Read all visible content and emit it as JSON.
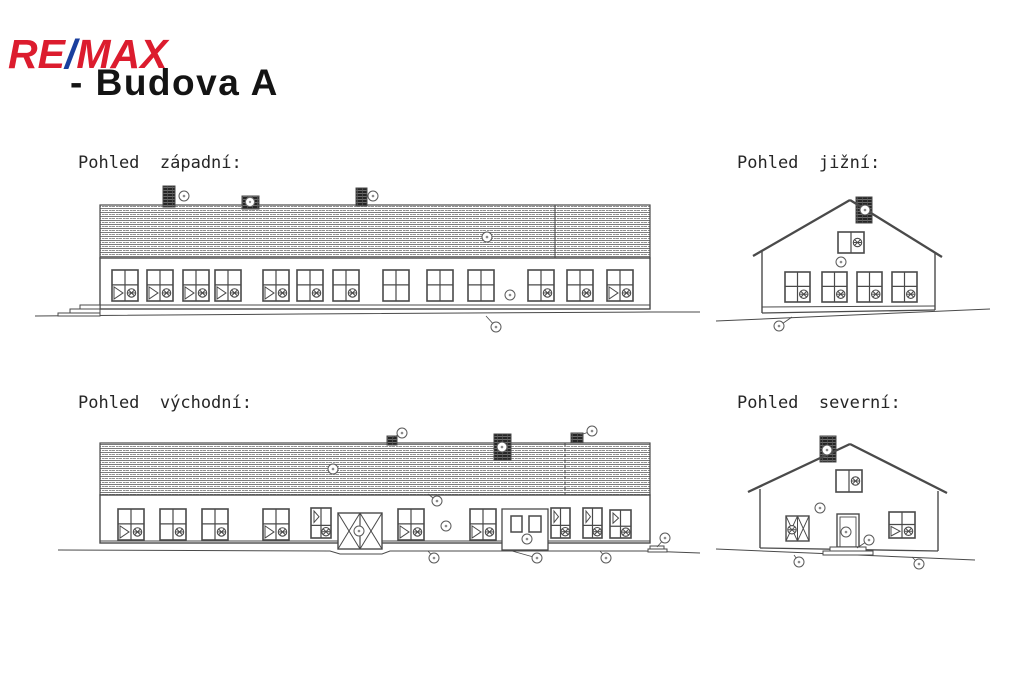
{
  "logo": {
    "re": "RE",
    "slash": "/",
    "max": "MAX",
    "re_color": "#dc1c2e",
    "slash_color": "#1a3f9e",
    "max_color": "#dc1c2e"
  },
  "title": "- Budova A",
  "labels": {
    "west": "Pohled  západní:",
    "south": "Pohled  jižní:",
    "east": "Pohled  východní:",
    "north": "Pohled  severní:"
  },
  "drawings": {
    "ink": "#4a4a4a",
    "west": {
      "type": "long",
      "roof": [
        100,
        205,
        550,
        53
      ],
      "seam": [
        555,
        false
      ],
      "wall": [
        100,
        258,
        550,
        51
      ],
      "plinth": 305,
      "ground": [
        [
          35,
          316
        ],
        [
          300,
          314
        ],
        [
          650,
          312
        ],
        [
          700,
          312
        ]
      ],
      "steps": [
        [
          80,
          305,
          20,
          4
        ],
        [
          70,
          309,
          30,
          4
        ],
        [
          58,
          313,
          42,
          3
        ]
      ],
      "win_def": [
        270,
        26,
        31
      ],
      "windows": [
        [
          112,
          "bl"
        ],
        [
          147,
          "bl"
        ],
        [
          183,
          "bl"
        ],
        [
          215,
          "bl"
        ],
        [
          263,
          "bl"
        ],
        [
          297,
          "br"
        ],
        [
          333,
          "br"
        ],
        [
          383,
          "p"
        ],
        [
          427,
          "p"
        ],
        [
          468,
          "p"
        ],
        [
          528,
          "br"
        ],
        [
          567,
          "br"
        ],
        [
          607,
          "bl"
        ]
      ],
      "chimneys": [
        [
          163,
          186,
          12,
          21
        ],
        [
          356,
          188,
          11,
          18
        ]
      ],
      "vent": [
        242,
        196,
        17,
        13
      ],
      "vent_circle": [
        250,
        202
      ],
      "callouts": [
        [
          184,
          196
        ],
        [
          373,
          196
        ],
        [
          487,
          237
        ],
        [
          510,
          295
        ],
        [
          496,
          327,
          486,
          316
        ]
      ]
    },
    "south": {
      "type": "gable",
      "apex": [
        850,
        200
      ],
      "eaves": [
        [
          753,
          256
        ],
        [
          942,
          257
        ]
      ],
      "wallL": [
        762,
        250,
        313
      ],
      "wallR": [
        935,
        253,
        310
      ],
      "plinth": [
        762,
        307,
        935,
        306
      ],
      "bottom": [
        762,
        313,
        935,
        310
      ],
      "ground": [
        [
          716,
          321
        ],
        [
          990,
          309
        ]
      ],
      "chimney": [
        856,
        197,
        16,
        26
      ],
      "gwin": [
        838,
        232,
        26,
        21
      ],
      "win_def": [
        272,
        25,
        30
      ],
      "windows": [
        [
          785,
          "br"
        ],
        [
          822,
          "br"
        ],
        [
          857,
          "br"
        ],
        [
          892,
          "br"
        ]
      ],
      "callouts": [
        [
          865,
          210
        ],
        [
          841,
          262
        ],
        [
          779,
          326,
          792,
          317
        ]
      ]
    },
    "east": {
      "type": "long",
      "roof": [
        100,
        443,
        550,
        52
      ],
      "seam": [
        565,
        true
      ],
      "wall": [
        100,
        495,
        550,
        48
      ],
      "plinth": 541,
      "ground": [
        [
          58,
          550
        ],
        [
          330,
          551
        ],
        [
          340,
          554
        ],
        [
          382,
          554
        ],
        [
          390,
          551
        ],
        [
          645,
          551
        ],
        [
          700,
          553
        ]
      ],
      "steps": [
        [
          650,
          546,
          14,
          3
        ],
        [
          648,
          549,
          19,
          3
        ]
      ],
      "win_def": [
        509,
        26,
        31
      ],
      "windows": [
        [
          118,
          "bl"
        ],
        [
          160,
          "br"
        ],
        [
          202,
          "br"
        ],
        [
          263,
          "bl"
        ],
        [
          311,
          "tl",
          20,
          30,
          508
        ],
        [
          398,
          "bl"
        ],
        [
          470,
          "bl"
        ],
        [
          551,
          "tl",
          19,
          30,
          508
        ],
        [
          583,
          "tl",
          19,
          30,
          508
        ],
        [
          610,
          "tl",
          21,
          28,
          510
        ]
      ],
      "chimneys": [
        [
          387,
          436,
          10,
          9
        ],
        [
          494,
          434,
          17,
          26
        ],
        [
          571,
          433,
          12,
          10
        ]
      ],
      "xdoor": [
        338,
        513,
        44,
        36
      ],
      "porch": {
        "rect": [
          502,
          509,
          46,
          41
        ],
        "wins": [
          [
            511,
            516,
            11,
            16
          ],
          [
            529,
            516,
            12,
            16
          ]
        ]
      },
      "callouts": [
        [
          402,
          433,
          392,
          438
        ],
        [
          502,
          447
        ],
        [
          592,
          431,
          580,
          435
        ],
        [
          333,
          469
        ],
        [
          437,
          501,
          428,
          494
        ],
        [
          446,
          526
        ],
        [
          359,
          531
        ],
        [
          527,
          539
        ],
        [
          434,
          558,
          428,
          551
        ],
        [
          537,
          558,
          512,
          551
        ],
        [
          606,
          558,
          600,
          551
        ],
        [
          665,
          538,
          657,
          547
        ]
      ]
    },
    "north": {
      "type": "gable",
      "apex": [
        850,
        444
      ],
      "eaves": [
        [
          748,
          492
        ],
        [
          947,
          493
        ]
      ],
      "wallL": [
        760,
        489,
        548
      ],
      "wallR": [
        938,
        491,
        551
      ],
      "bottom": [
        760,
        548,
        938,
        551
      ],
      "ground": [
        [
          716,
          549
        ],
        [
          975,
          560
        ]
      ],
      "chimney": [
        820,
        436,
        16,
        26
      ],
      "gwin": [
        836,
        470,
        26,
        22
      ],
      "win_def": [
        512,
        26,
        26
      ],
      "windows": [
        [
          889,
          "bl"
        ]
      ],
      "xwin": [
        786,
        516,
        23,
        25
      ],
      "door": [
        837,
        514,
        22,
        33
      ],
      "steps": [
        [
          830,
          547,
          36,
          4
        ],
        [
          823,
          551,
          50,
          4
        ]
      ],
      "callouts": [
        [
          827,
          450
        ],
        [
          820,
          508
        ],
        [
          846,
          532
        ],
        [
          869,
          540,
          857,
          548
        ],
        [
          799,
          562,
          794,
          555
        ],
        [
          919,
          564,
          912,
          557
        ]
      ]
    }
  }
}
